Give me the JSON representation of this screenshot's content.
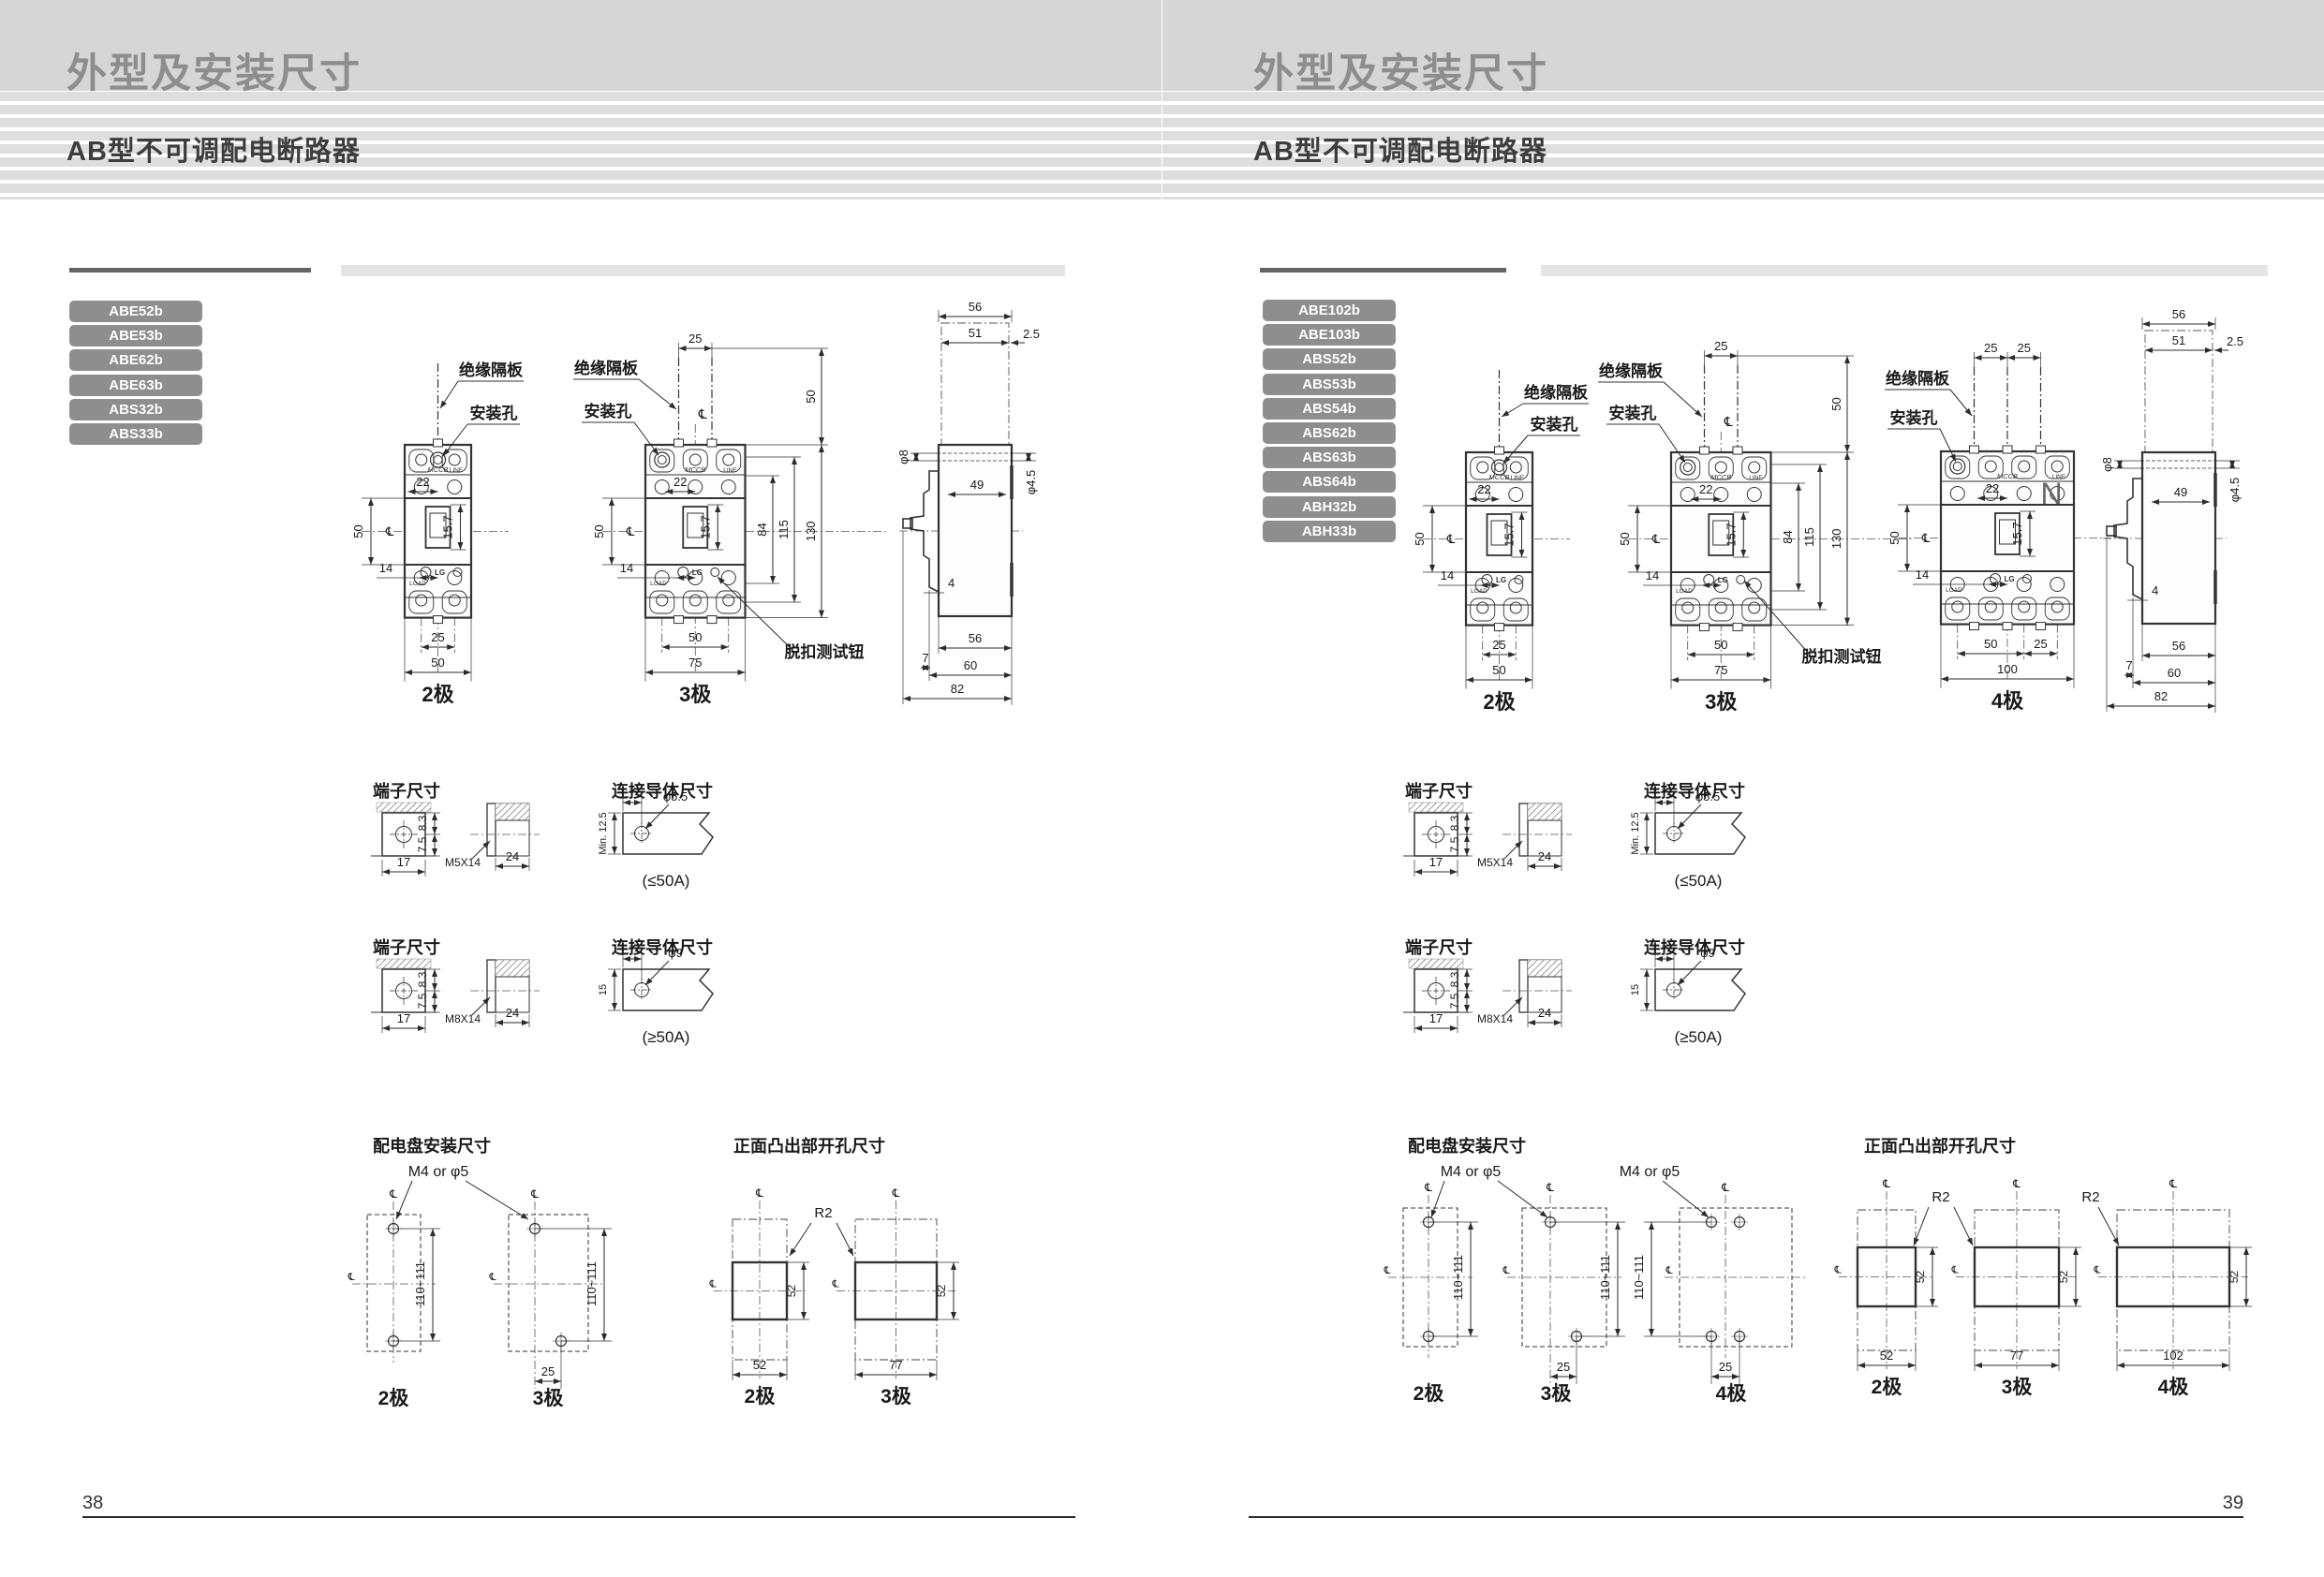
{
  "common": {
    "title": "外型及安装尺寸",
    "subtitle": "AB型不可调配电断路器",
    "labels": {
      "insulation_barrier": "绝缘隔板",
      "mounting_hole": "安装孔",
      "trip_test_button": "脱扣测试钮",
      "centerline": "℄",
      "pole2": "2极",
      "pole3": "3极",
      "pole4": "4极",
      "terminal_size": "端子尺寸",
      "conductor_size": "连接导体尺寸",
      "panel_mount": "配电盘安装尺寸",
      "front_cutout": "正面凸出部开孔尺寸",
      "le_50a": "(≤50A)",
      "ge_50a": "(≥50A)",
      "m4_or_phi5": "M4 or φ5",
      "r2": "R2",
      "neutral": "N",
      "mccb": "MCCB",
      "line": "LINE",
      "load": "LOAD",
      "lg": "LG"
    },
    "dims": {
      "d22": "22",
      "d50": "50",
      "d14": "14",
      "d15_7": "15.7",
      "d25": "25",
      "d75": "75",
      "d84": "84",
      "d115": "115",
      "d130": "130",
      "d56": "56",
      "d51": "51",
      "d2_5": "2.5",
      "phi8": "φ8",
      "d49": "49",
      "phi4_5": "φ4.5",
      "d4": "4",
      "d7": "7",
      "d60": "60",
      "d82": "82",
      "d17": "17",
      "d8_3": "8.3",
      "d7_5": "7.5",
      "m5x14": "M5X14",
      "m8x14": "M8X14",
      "d24": "24",
      "phi5_5": "φ5.5",
      "min12_5": "Min. 12.5",
      "d15": "15",
      "phi9": "φ9",
      "d110_111": "110~111",
      "d52": "52",
      "d77": "77",
      "d102": "102",
      "d100": "100"
    }
  },
  "page_left": {
    "models": [
      "ABE52b",
      "ABE53b",
      "ABE62b",
      "ABE63b",
      "ABS32b",
      "ABS33b"
    ],
    "page_number": "38"
  },
  "page_right": {
    "models": [
      "ABE102b",
      "ABE103b",
      "ABS52b",
      "ABS53b",
      "ABS54b",
      "ABS62b",
      "ABS63b",
      "ABS64b",
      "ABH32b",
      "ABH33b"
    ],
    "page_number": "39"
  }
}
